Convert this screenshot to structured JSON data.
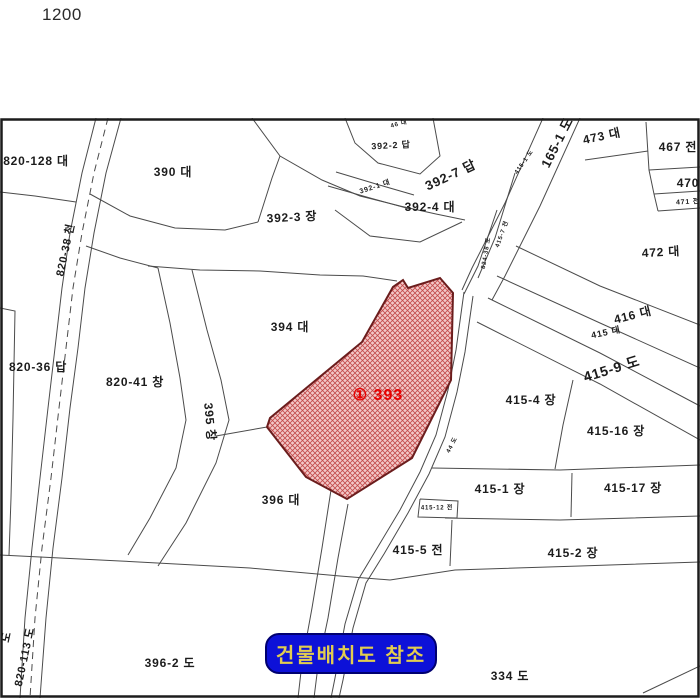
{
  "scale": {
    "value": "1200"
  },
  "reference_button": {
    "label": "건물배치도 참조",
    "bg": "#0d11d8",
    "text_color": "#e2cd4f"
  },
  "subject_parcel": {
    "label": "① 393",
    "label_color": "#e80000",
    "label_x": 378,
    "label_y": 282,
    "label_size": 16,
    "fill_base": "#f3c9c9",
    "hatch_color": "#c24a4a",
    "outline": "#6b1d1d",
    "points": [
      [
        403,
        162
      ],
      [
        408,
        170
      ],
      [
        440,
        160
      ],
      [
        453,
        175
      ],
      [
        451,
        262
      ],
      [
        412,
        340
      ],
      [
        347,
        381
      ],
      [
        306,
        359
      ],
      [
        267,
        309
      ],
      [
        270,
        300
      ],
      [
        362,
        224
      ],
      [
        393,
        169
      ]
    ]
  },
  "map": {
    "border_color": "#1c1c1c",
    "line_color": "#4b4b4b",
    "labels": [
      {
        "t": "820-128 대",
        "x": 36,
        "y": 44,
        "r": 0,
        "s": 12
      },
      {
        "t": "390 대",
        "x": 173,
        "y": 55,
        "r": 0,
        "s": 12
      },
      {
        "t": "392-3 장",
        "x": 292,
        "y": 100,
        "r": -3,
        "s": 12
      },
      {
        "t": "392-2 답",
        "x": 391,
        "y": 28,
        "r": -3,
        "s": 9
      },
      {
        "t": "392-7 답",
        "x": 451,
        "y": 58,
        "r": -25,
        "s": 13
      },
      {
        "t": "392-1 대",
        "x": 375,
        "y": 69,
        "r": -18,
        "s": 7
      },
      {
        "t": "392-4 대",
        "x": 430,
        "y": 90,
        "r": 0,
        "s": 12
      },
      {
        "t": "165-1 도",
        "x": 558,
        "y": 25,
        "r": -63,
        "s": 13
      },
      {
        "t": "473 대",
        "x": 602,
        "y": 19,
        "r": -12,
        "s": 12
      },
      {
        "t": "467 전",
        "x": 678,
        "y": 30,
        "r": 0,
        "s": 12
      },
      {
        "t": "470",
        "x": 688,
        "y": 66,
        "r": 0,
        "s": 12
      },
      {
        "t": "471 전",
        "x": 688,
        "y": 84,
        "r": -3,
        "s": 7
      },
      {
        "t": "472 대",
        "x": 661,
        "y": 135,
        "r": -3,
        "s": 12
      },
      {
        "t": "416 대",
        "x": 633,
        "y": 198,
        "r": -14,
        "s": 12
      },
      {
        "t": "415 대",
        "x": 606,
        "y": 215,
        "r": -12,
        "s": 9
      },
      {
        "t": "415-9 도",
        "x": 612,
        "y": 252,
        "r": -17,
        "s": 14
      },
      {
        "t": "415-4 장",
        "x": 531,
        "y": 283,
        "r": 0,
        "s": 12
      },
      {
        "t": "415-16 장",
        "x": 616,
        "y": 314,
        "r": 0,
        "s": 12
      },
      {
        "t": "415-1 장",
        "x": 500,
        "y": 372,
        "r": 0,
        "s": 12
      },
      {
        "t": "415-17 장",
        "x": 633,
        "y": 371,
        "r": 0,
        "s": 12
      },
      {
        "t": "415-12 전",
        "x": 437,
        "y": 390,
        "r": 0,
        "s": 6
      },
      {
        "t": "415-5 전",
        "x": 418,
        "y": 433,
        "r": 0,
        "s": 12
      },
      {
        "t": "415-2 장",
        "x": 573,
        "y": 436,
        "r": 0,
        "s": 12
      },
      {
        "t": "334 도",
        "x": 510,
        "y": 559,
        "r": 0,
        "s": 12
      },
      {
        "t": "396-2 도",
        "x": 170,
        "y": 546,
        "r": 0,
        "s": 12
      },
      {
        "t": "396 대",
        "x": 281,
        "y": 383,
        "r": 0,
        "s": 12
      },
      {
        "t": "394 대",
        "x": 290,
        "y": 210,
        "r": 0,
        "s": 12
      },
      {
        "t": "820-41 창",
        "x": 135,
        "y": 265,
        "r": 0,
        "s": 12
      },
      {
        "t": "395 창",
        "x": 209,
        "y": 304,
        "r": 85,
        "s": 12
      },
      {
        "t": "820-36 답",
        "x": 38,
        "y": 250,
        "r": 0,
        "s": 12
      },
      {
        "t": "820-38 천",
        "x": 66,
        "y": 132,
        "r": -78,
        "s": 11
      },
      {
        "t": "820-113 도",
        "x": 25,
        "y": 539,
        "r": -78,
        "s": 11
      },
      {
        "t": "도",
        "x": 7,
        "y": 519,
        "r": -78,
        "s": 11
      },
      {
        "t": "824-38 도",
        "x": 486,
        "y": 135,
        "r": -80,
        "s": 6
      },
      {
        "t": "415-7 전",
        "x": 502,
        "y": 116,
        "r": -70,
        "s": 6
      },
      {
        "t": "415-1 도",
        "x": 524,
        "y": 44,
        "r": -55,
        "s": 6
      },
      {
        "t": "44 도",
        "x": 452,
        "y": 327,
        "r": -62,
        "s": 6
      },
      {
        "t": "46 대",
        "x": 399,
        "y": 6,
        "r": -15,
        "s": 6
      }
    ],
    "lines": [
      {
        "p": [
          [
            96,
            0
          ],
          [
            82,
            55
          ],
          [
            70,
            115
          ],
          [
            62,
            170
          ],
          [
            55,
            230
          ],
          [
            48,
            290
          ],
          [
            40,
            360
          ],
          [
            32,
            430
          ],
          [
            25,
            500
          ],
          [
            20,
            580
          ]
        ]
      },
      {
        "p": [
          [
            121,
            0
          ],
          [
            106,
            55
          ],
          [
            94,
            115
          ],
          [
            85,
            170
          ],
          [
            78,
            230
          ],
          [
            70,
            290
          ],
          [
            62,
            360
          ],
          [
            53,
            430
          ],
          [
            46,
            500
          ],
          [
            40,
            580
          ]
        ]
      },
      {
        "p": [
          [
            108,
            0
          ],
          [
            94,
            55
          ],
          [
            82,
            115
          ],
          [
            73,
            170
          ],
          [
            66,
            230
          ],
          [
            59,
            290
          ],
          [
            51,
            360
          ],
          [
            42,
            430
          ],
          [
            35,
            500
          ],
          [
            30,
            580
          ]
        ],
        "d": "7 5"
      },
      {
        "p": [
          [
            0,
            74
          ],
          [
            35,
            78
          ],
          [
            76,
            84
          ]
        ]
      },
      {
        "p": [
          [
            0,
            190
          ],
          [
            15,
            193
          ],
          [
            13,
            300
          ],
          [
            11,
            380
          ],
          [
            9,
            437
          ]
        ]
      },
      {
        "p": [
          [
            90,
            76
          ],
          [
            130,
            98
          ],
          [
            175,
            110
          ],
          [
            225,
            112
          ],
          [
            258,
            104
          ]
        ]
      },
      {
        "p": [
          [
            258,
            104
          ],
          [
            272,
            60
          ],
          [
            280,
            38
          ]
        ]
      },
      {
        "p": [
          [
            252,
            0
          ],
          [
            280,
            38
          ],
          [
            322,
            62
          ],
          [
            360,
            78
          ],
          [
            400,
            88
          ],
          [
            436,
            96
          ],
          [
            465,
            102
          ]
        ]
      },
      {
        "p": [
          [
            148,
            148
          ],
          [
            200,
            152
          ],
          [
            260,
            153
          ],
          [
            320,
            157
          ],
          [
            363,
            158
          ],
          [
            397,
            163
          ]
        ]
      },
      {
        "p": [
          [
            158,
            150
          ],
          [
            170,
            205
          ],
          [
            180,
            260
          ],
          [
            186,
            302
          ],
          [
            176,
            350
          ],
          [
            150,
            400
          ],
          [
            128,
            437
          ]
        ]
      },
      {
        "p": [
          [
            192,
            152
          ],
          [
            207,
            212
          ],
          [
            221,
            262
          ],
          [
            229,
            302
          ],
          [
            216,
            345
          ],
          [
            186,
            405
          ],
          [
            158,
            448
          ]
        ]
      },
      {
        "p": [
          [
            345,
            0
          ],
          [
            355,
            25
          ],
          [
            378,
            45
          ],
          [
            420,
            56
          ],
          [
            440,
            38
          ],
          [
            433,
            0
          ]
        ]
      },
      {
        "p": [
          [
            336,
            54
          ],
          [
            376,
            66
          ],
          [
            414,
            77
          ]
        ]
      },
      {
        "p": [
          [
            328,
            68
          ],
          [
            370,
            80
          ],
          [
            410,
            91
          ]
        ]
      },
      {
        "p": [
          [
            216,
            318
          ],
          [
            267,
            309
          ]
        ]
      },
      {
        "p": [
          [
            543,
            0
          ],
          [
            505,
            85
          ],
          [
            472,
            150
          ],
          [
            462,
            172
          ]
        ]
      },
      {
        "p": [
          [
            580,
            0
          ],
          [
            540,
            88
          ],
          [
            505,
            158
          ],
          [
            492,
            182
          ]
        ]
      },
      {
        "p": [
          [
            497,
            92
          ],
          [
            478,
            148
          ],
          [
            464,
            176
          ]
        ]
      },
      {
        "p": [
          [
            515,
            55
          ],
          [
            495,
            120
          ],
          [
            478,
            160
          ]
        ]
      },
      {
        "p": [
          [
            464,
            174
          ],
          [
            456,
            232
          ],
          [
            448,
            272
          ],
          [
            436,
            317
          ],
          [
            420,
            354
          ],
          [
            400,
            392
          ],
          [
            376,
            432
          ],
          [
            358,
            462
          ],
          [
            345,
            506
          ],
          [
            335,
            560
          ],
          [
            331,
            580
          ]
        ]
      },
      {
        "p": [
          [
            473,
            178
          ],
          [
            465,
            234
          ],
          [
            457,
            274
          ],
          [
            445,
            319
          ],
          [
            429,
            356
          ],
          [
            408,
            395
          ],
          [
            384,
            436
          ],
          [
            366,
            465
          ],
          [
            353,
            510
          ],
          [
            343,
            562
          ],
          [
            339,
            580
          ]
        ]
      },
      {
        "p": [
          [
            331,
            372
          ],
          [
            322,
            430
          ],
          [
            312,
            490
          ],
          [
            302,
            545
          ],
          [
            298,
            580
          ]
        ]
      },
      {
        "p": [
          [
            348,
            386
          ],
          [
            338,
            440
          ],
          [
            328,
            500
          ],
          [
            318,
            548
          ],
          [
            314,
            580
          ]
        ]
      },
      {
        "p": [
          [
            516,
            128
          ],
          [
            600,
            168
          ],
          [
            700,
            207
          ]
        ]
      },
      {
        "p": [
          [
            497,
            158
          ],
          [
            600,
            205
          ],
          [
            700,
            250
          ]
        ]
      },
      {
        "p": [
          [
            488,
            180
          ],
          [
            600,
            235
          ],
          [
            700,
            288
          ]
        ]
      },
      {
        "p": [
          [
            477,
            204
          ],
          [
            600,
            266
          ],
          [
            700,
            322
          ]
        ]
      },
      {
        "p": [
          [
            432,
            350
          ],
          [
            560,
            352
          ],
          [
            700,
            347
          ]
        ]
      },
      {
        "p": [
          [
            573,
            262
          ],
          [
            563,
            307
          ],
          [
            555,
            351
          ]
        ]
      },
      {
        "p": [
          [
            572,
            355
          ],
          [
            571,
            399
          ]
        ]
      },
      {
        "p": [
          [
            445,
            400
          ],
          [
            560,
            402
          ],
          [
            700,
            398
          ]
        ]
      },
      {
        "p": [
          [
            420,
            381
          ],
          [
            458,
            383
          ],
          [
            457,
            400
          ],
          [
            418,
            399
          ],
          [
            420,
            381
          ]
        ]
      },
      {
        "p": [
          [
            452,
            402
          ],
          [
            450,
            448
          ]
        ]
      },
      {
        "p": [
          [
            390,
            462
          ],
          [
            455,
            452
          ],
          [
            580,
            448
          ],
          [
            700,
            444
          ]
        ]
      },
      {
        "p": [
          [
            0,
            437
          ],
          [
            120,
            443
          ],
          [
            250,
            450
          ],
          [
            340,
            458
          ],
          [
            390,
            462
          ]
        ]
      },
      {
        "p": [
          [
            643,
            575
          ],
          [
            700,
            548
          ]
        ]
      },
      {
        "p": [
          [
            646,
            4
          ],
          [
            649,
            52
          ],
          [
            654,
            76
          ],
          [
            658,
            93
          ]
        ]
      },
      {
        "p": [
          [
            585,
            42
          ],
          [
            648,
            33
          ]
        ]
      },
      {
        "p": [
          [
            649,
            52
          ],
          [
            700,
            49
          ]
        ]
      },
      {
        "p": [
          [
            654,
            76
          ],
          [
            700,
            73
          ]
        ]
      },
      {
        "p": [
          [
            658,
            93
          ],
          [
            700,
            90
          ]
        ]
      },
      {
        "p": [
          [
            86,
            128
          ],
          [
            120,
            140
          ],
          [
            158,
            150
          ]
        ]
      },
      {
        "p": [
          [
            335,
            92
          ],
          [
            370,
            118
          ],
          [
            420,
            124
          ],
          [
            462,
            104
          ]
        ]
      }
    ]
  }
}
